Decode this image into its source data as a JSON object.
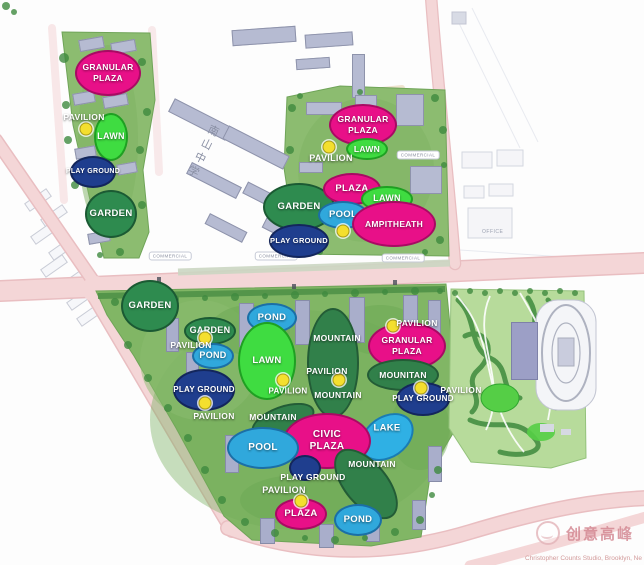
{
  "map": {
    "school_label": "南山中学",
    "office_label": "OFFICE",
    "commercial_label": "COMMERCIAL",
    "commercial_capsules": [
      {
        "x": 170,
        "y": 256
      },
      {
        "x": 276,
        "y": 256
      },
      {
        "x": 403,
        "y": 258
      },
      {
        "x": 418,
        "y": 155
      }
    ],
    "road_glyphs": [
      {
        "x": 157,
        "y": 277
      },
      {
        "x": 292,
        "y": 284
      },
      {
        "x": 393,
        "y": 280
      }
    ],
    "zone_colors": {
      "plaza": {
        "fill": "#E81088",
        "stroke": "#A80A63"
      },
      "lawn": {
        "fill": "#3FDC41",
        "stroke": "#1FA022"
      },
      "garden": {
        "fill": "#2E8B4F",
        "stroke": "#1B5A33"
      },
      "mountain": {
        "fill": "#31804A",
        "stroke": "#235C36"
      },
      "pond": {
        "fill": "#30A8DC",
        "stroke": "#1B6FA6"
      },
      "pool": {
        "fill": "#30A8DC",
        "stroke": "#1B6FA6"
      },
      "playground": {
        "fill": "#1F3E8E",
        "stroke": "#13265C"
      },
      "lake": {
        "fill": "#2FB0E4",
        "stroke": "#1A7CB4"
      }
    },
    "marker_color": "#F4DF2E",
    "zones": [
      {
        "cx": 108,
        "cy": 73,
        "rx": 33,
        "ry": 23,
        "rot": 0,
        "type": "plaza",
        "lines": [
          "GRANULAR",
          "PLAZA"
        ],
        "fs": 8.5
      },
      {
        "cx": 111,
        "cy": 137,
        "rx": 17,
        "ry": 24,
        "rot": 0,
        "type": "lawn",
        "lines": [
          "LAWN"
        ],
        "fs": 9
      },
      {
        "cx": 93,
        "cy": 172,
        "rx": 23,
        "ry": 16,
        "rot": 0,
        "type": "playground",
        "lines": [
          "PLAY GROUND"
        ],
        "fs": 7
      },
      {
        "cx": 111,
        "cy": 214,
        "rx": 26,
        "ry": 24,
        "rot": 0,
        "type": "garden",
        "lines": [
          "GARDEN"
        ],
        "fs": 9.5
      },
      {
        "cx": 363,
        "cy": 125,
        "rx": 34,
        "ry": 21,
        "rot": 0,
        "type": "plaza",
        "lines": [
          "GRANULAR",
          "PLAZA"
        ],
        "fs": 8.5
      },
      {
        "cx": 367,
        "cy": 149,
        "rx": 21,
        "ry": 11,
        "rot": 0,
        "type": "lawn",
        "lines": [
          "LAWN"
        ],
        "fs": 8.5
      },
      {
        "cx": 299,
        "cy": 207,
        "rx": 36,
        "ry": 24,
        "rot": 0,
        "type": "garden",
        "lines": [
          "GARDEN"
        ],
        "fs": 9.5
      },
      {
        "cx": 352,
        "cy": 189,
        "rx": 29,
        "ry": 16,
        "rot": 0,
        "type": "plaza",
        "lines": [
          "PLAZA"
        ],
        "fs": 9.5
      },
      {
        "cx": 387,
        "cy": 199,
        "rx": 26,
        "ry": 13,
        "rot": 0,
        "type": "lawn",
        "lines": [
          "LAWN"
        ],
        "fs": 9
      },
      {
        "cx": 343,
        "cy": 215,
        "rx": 25,
        "ry": 14,
        "rot": 0,
        "type": "pool",
        "lines": [
          "POOL"
        ],
        "fs": 9.5
      },
      {
        "cx": 394,
        "cy": 224,
        "rx": 42,
        "ry": 23,
        "rot": 0,
        "type": "plaza",
        "lines": [
          "AMPITHEATH"
        ],
        "fs": 8.5
      },
      {
        "cx": 299,
        "cy": 241,
        "rx": 30,
        "ry": 17,
        "rot": 0,
        "type": "playground",
        "lines": [
          "PLAY GROUND"
        ],
        "fs": 7.5
      },
      {
        "cx": 150,
        "cy": 306,
        "rx": 29,
        "ry": 26,
        "rot": 0,
        "type": "garden",
        "lines": [
          "GARDEN"
        ],
        "fs": 9.5
      },
      {
        "cx": 210,
        "cy": 331,
        "rx": 26,
        "ry": 14,
        "rot": 0,
        "type": "garden",
        "lines": [
          "GARDEN"
        ],
        "fs": 9
      },
      {
        "cx": 213,
        "cy": 356,
        "rx": 21,
        "ry": 13,
        "rot": 0,
        "type": "pond",
        "lines": [
          "POND"
        ],
        "fs": 9
      },
      {
        "cx": 204,
        "cy": 390,
        "rx": 31,
        "ry": 21,
        "rot": 0,
        "type": "playground",
        "lines": [
          "PLAY GROUND"
        ],
        "fs": 8
      },
      {
        "cx": 272,
        "cy": 318,
        "rx": 25,
        "ry": 15,
        "rot": 0,
        "type": "pond",
        "lines": [
          "POND"
        ],
        "fs": 9.5
      },
      {
        "cx": 267,
        "cy": 361,
        "rx": 29,
        "ry": 39,
        "rot": 0,
        "type": "lawn",
        "lines": [
          "LAWN"
        ],
        "fs": 9.5
      },
      {
        "cx": 333,
        "cy": 363,
        "rx": 26,
        "ry": 55,
        "rot": 0,
        "type": "mountain",
        "lines": [],
        "fs": 9
      },
      {
        "cx": 407,
        "cy": 346,
        "rx": 39,
        "ry": 24,
        "rot": 0,
        "type": "plaza",
        "lines": [
          "GRANULAR",
          "PLAZA"
        ],
        "fs": 8.5
      },
      {
        "cx": 403,
        "cy": 375,
        "rx": 36,
        "ry": 16,
        "rot": 0,
        "type": "mountain",
        "lines": [
          "MOUNITAN"
        ],
        "fs": 8.5
      },
      {
        "cx": 423,
        "cy": 399,
        "rx": 27,
        "ry": 17,
        "rot": 0,
        "type": "playground",
        "lines": [
          "PLAY GROUND"
        ],
        "fs": 8
      },
      {
        "cx": 387,
        "cy": 437,
        "rx": 29,
        "ry": 21,
        "rot": -35,
        "type": "lake",
        "lines": [],
        "fs": 9
      },
      {
        "cx": 283,
        "cy": 421,
        "rx": 33,
        "ry": 15,
        "rot": -20,
        "type": "mountain",
        "lines": [],
        "fs": 9
      },
      {
        "cx": 327,
        "cy": 441,
        "rx": 44,
        "ry": 28,
        "rot": 0,
        "type": "plaza",
        "lines": [
          "CIVIC",
          "PLAZA"
        ],
        "fs": 10
      },
      {
        "cx": 263,
        "cy": 448,
        "rx": 36,
        "ry": 21,
        "rot": 0,
        "type": "pool",
        "lines": [
          "POOL"
        ],
        "fs": 10
      },
      {
        "cx": 366,
        "cy": 484,
        "rx": 22,
        "ry": 42,
        "rot": -40,
        "type": "mountain",
        "lines": [],
        "fs": 9
      },
      {
        "cx": 305,
        "cy": 468,
        "rx": 16,
        "ry": 13,
        "rot": 0,
        "type": "playground",
        "lines": [],
        "fs": 8
      },
      {
        "cx": 301,
        "cy": 514,
        "rx": 26,
        "ry": 16,
        "rot": 0,
        "type": "plaza",
        "lines": [
          "PLAZA"
        ],
        "fs": 9.5
      },
      {
        "cx": 358,
        "cy": 520,
        "rx": 24,
        "ry": 16,
        "rot": 0,
        "type": "pond",
        "lines": [
          "POND"
        ],
        "fs": 9.5
      }
    ],
    "floating_labels": [
      {
        "x": 84,
        "y": 117,
        "text": "PAVILION",
        "fs": 8.5
      },
      {
        "x": 331,
        "y": 158,
        "text": "PAVILION",
        "fs": 9
      },
      {
        "x": 191,
        "y": 345,
        "text": "PAVILION",
        "fs": 8.5
      },
      {
        "x": 214,
        "y": 416,
        "text": "PAVILION",
        "fs": 8.5
      },
      {
        "x": 288,
        "y": 391,
        "text": "PAVILION",
        "fs": 8
      },
      {
        "x": 327,
        "y": 371,
        "text": "PAVILION",
        "fs": 8.5
      },
      {
        "x": 417,
        "y": 323,
        "text": "PAVILION",
        "fs": 8.5
      },
      {
        "x": 461,
        "y": 390,
        "text": "PAVILION",
        "fs": 8.5
      },
      {
        "x": 284,
        "y": 490,
        "text": "PAVILION",
        "fs": 9
      },
      {
        "x": 337,
        "y": 338,
        "text": "MOUNTAIN",
        "fs": 8.5
      },
      {
        "x": 338,
        "y": 395,
        "text": "MOUNTAIN",
        "fs": 8.5
      },
      {
        "x": 273,
        "y": 417,
        "text": "MOUNTAIN",
        "fs": 8.5
      },
      {
        "x": 372,
        "y": 464,
        "text": "MOUNTAIN",
        "fs": 8.5
      },
      {
        "x": 387,
        "y": 428,
        "text": "LAKE",
        "fs": 9.5
      },
      {
        "x": 313,
        "y": 477,
        "text": "PLAY GROUND",
        "fs": 8.5
      }
    ],
    "pavilion_markers": [
      {
        "x": 86,
        "y": 129
      },
      {
        "x": 329,
        "y": 147
      },
      {
        "x": 343,
        "y": 231
      },
      {
        "x": 205,
        "y": 338
      },
      {
        "x": 205,
        "y": 403
      },
      {
        "x": 283,
        "y": 380
      },
      {
        "x": 339,
        "y": 380
      },
      {
        "x": 393,
        "y": 326
      },
      {
        "x": 421,
        "y": 388
      },
      {
        "x": 301,
        "y": 501
      }
    ]
  },
  "watermark": {
    "brand": "创意高峰",
    "credit": "Christopher Counts Studio, Brooklyn, Ne"
  }
}
